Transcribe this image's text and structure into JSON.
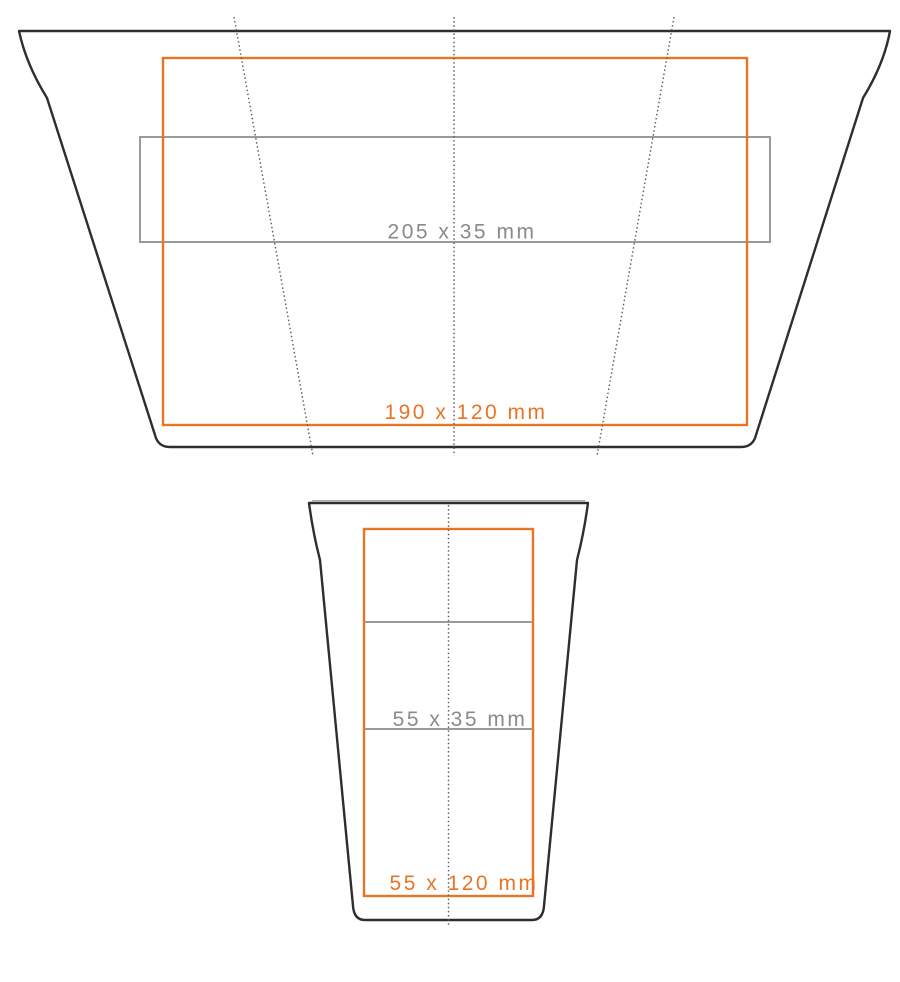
{
  "colors": {
    "background": "#ffffff",
    "outline": "#2e2e2e",
    "orange": "#e87425",
    "gray": "#9a9a9a",
    "graytext": "#8a8a8a",
    "dotted": "#5b5b5b"
  },
  "views": {
    "flat": {
      "gray_area_label": "205 x 35 mm",
      "orange_area_label": "190 x 120 mm"
    },
    "front": {
      "gray_area_label": "55 x 35 mm",
      "orange_area_label": "55 x 120 mm"
    }
  }
}
